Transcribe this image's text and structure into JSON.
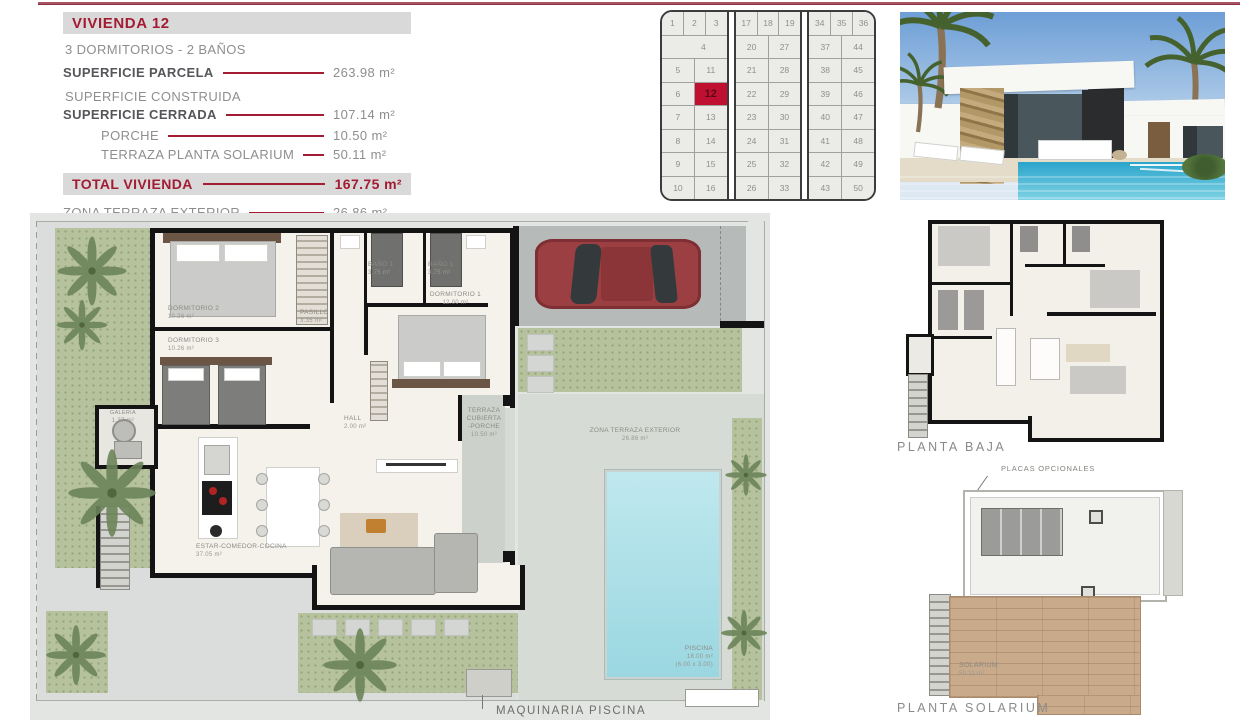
{
  "colors": {
    "accent": "#a21c33",
    "highlight_cell": "#c01031",
    "pool": "#a9dde6"
  },
  "info": {
    "title": "VIVIENDA 12",
    "subtitle": "3 DORMITORIOS - 2 BAÑOS",
    "construida": "SUPERFICIE CONSTRUIDA",
    "rows": [
      {
        "label": "SUPERFICIE PARCELA",
        "value": "263.98 m²"
      },
      {
        "label": "SUPERFICIE CERRADA",
        "value": "107.14 m²"
      },
      {
        "label": "PORCHE",
        "value": "10.50 m²"
      },
      {
        "label": "TERRAZA PLANTA SOLARIUM",
        "value": "50.11 m²"
      }
    ],
    "total": {
      "label": "TOTAL VIVIENDA",
      "value": "167.75 m²"
    },
    "terraza": {
      "label": "ZONA TERRAZA EXTERIOR",
      "value": "26.86 m²"
    }
  },
  "site_map": {
    "highlight": "12",
    "blocks": [
      {
        "top": [
          "1",
          "2",
          "3"
        ],
        "wide": "4",
        "rows": [
          [
            "5",
            "11"
          ],
          [
            "6",
            "12"
          ],
          [
            "7",
            "13"
          ],
          [
            "8",
            "14"
          ],
          [
            "9",
            "15"
          ],
          [
            "10",
            "16"
          ]
        ]
      },
      {
        "top": [
          "17",
          "18",
          "19"
        ],
        "rows": [
          [
            "20",
            "27"
          ],
          [
            "21",
            "28"
          ],
          [
            "22",
            "29"
          ],
          [
            "23",
            "30"
          ],
          [
            "24",
            "31"
          ],
          [
            "25",
            "32"
          ],
          [
            "26",
            "33"
          ]
        ]
      },
      {
        "top": [
          "34",
          "35",
          "36"
        ],
        "rows": [
          [
            "37",
            "44"
          ],
          [
            "38",
            "45"
          ],
          [
            "39",
            "46"
          ],
          [
            "40",
            "47"
          ],
          [
            "41",
            "48"
          ],
          [
            "42",
            "49"
          ],
          [
            "43",
            "50"
          ]
        ]
      }
    ]
  },
  "plan": {
    "rooms": [
      {
        "name": "DORMITORIO 2",
        "area": "10.26 m²"
      },
      {
        "name": "DORMITORIO 3",
        "area": "10.26 m²"
      },
      {
        "name": "PASILLO",
        "area": "3.35 m²"
      },
      {
        "name": "BAÑO 1",
        "area": "3.75 m²"
      },
      {
        "name": "BAÑO 1",
        "area": "3.75 m²"
      },
      {
        "name": "DORMITORIO 1",
        "area": "12.00 m²"
      },
      {
        "name": "HALL",
        "area": "2.00 m²"
      },
      {
        "name": "TERRAZA CUBIERTA",
        "name2": "-PORCHE",
        "area": "10.50 m²"
      },
      {
        "name": "ZONA TERRAZA EXTERIOR",
        "area": "26.86 m²"
      },
      {
        "name": "ESTAR-COMEDOR-COCINA",
        "area": "37.05 m²"
      },
      {
        "name": "GALERIA",
        "area": "1.37 m²"
      }
    ],
    "pool": {
      "name": "PISCINA",
      "area": "18.00 m²",
      "dims": "(6.00 x 3.00)"
    },
    "footer": "MAQUINARIA PISCINA"
  },
  "planta_baja": {
    "label": "PLANTA BAJA"
  },
  "solarium": {
    "label": "PLANTA SOLARIUM",
    "placas": "PLACAS OPCIONALES",
    "room": {
      "name": "SOLARIUM",
      "area": "50.11 m²"
    }
  }
}
